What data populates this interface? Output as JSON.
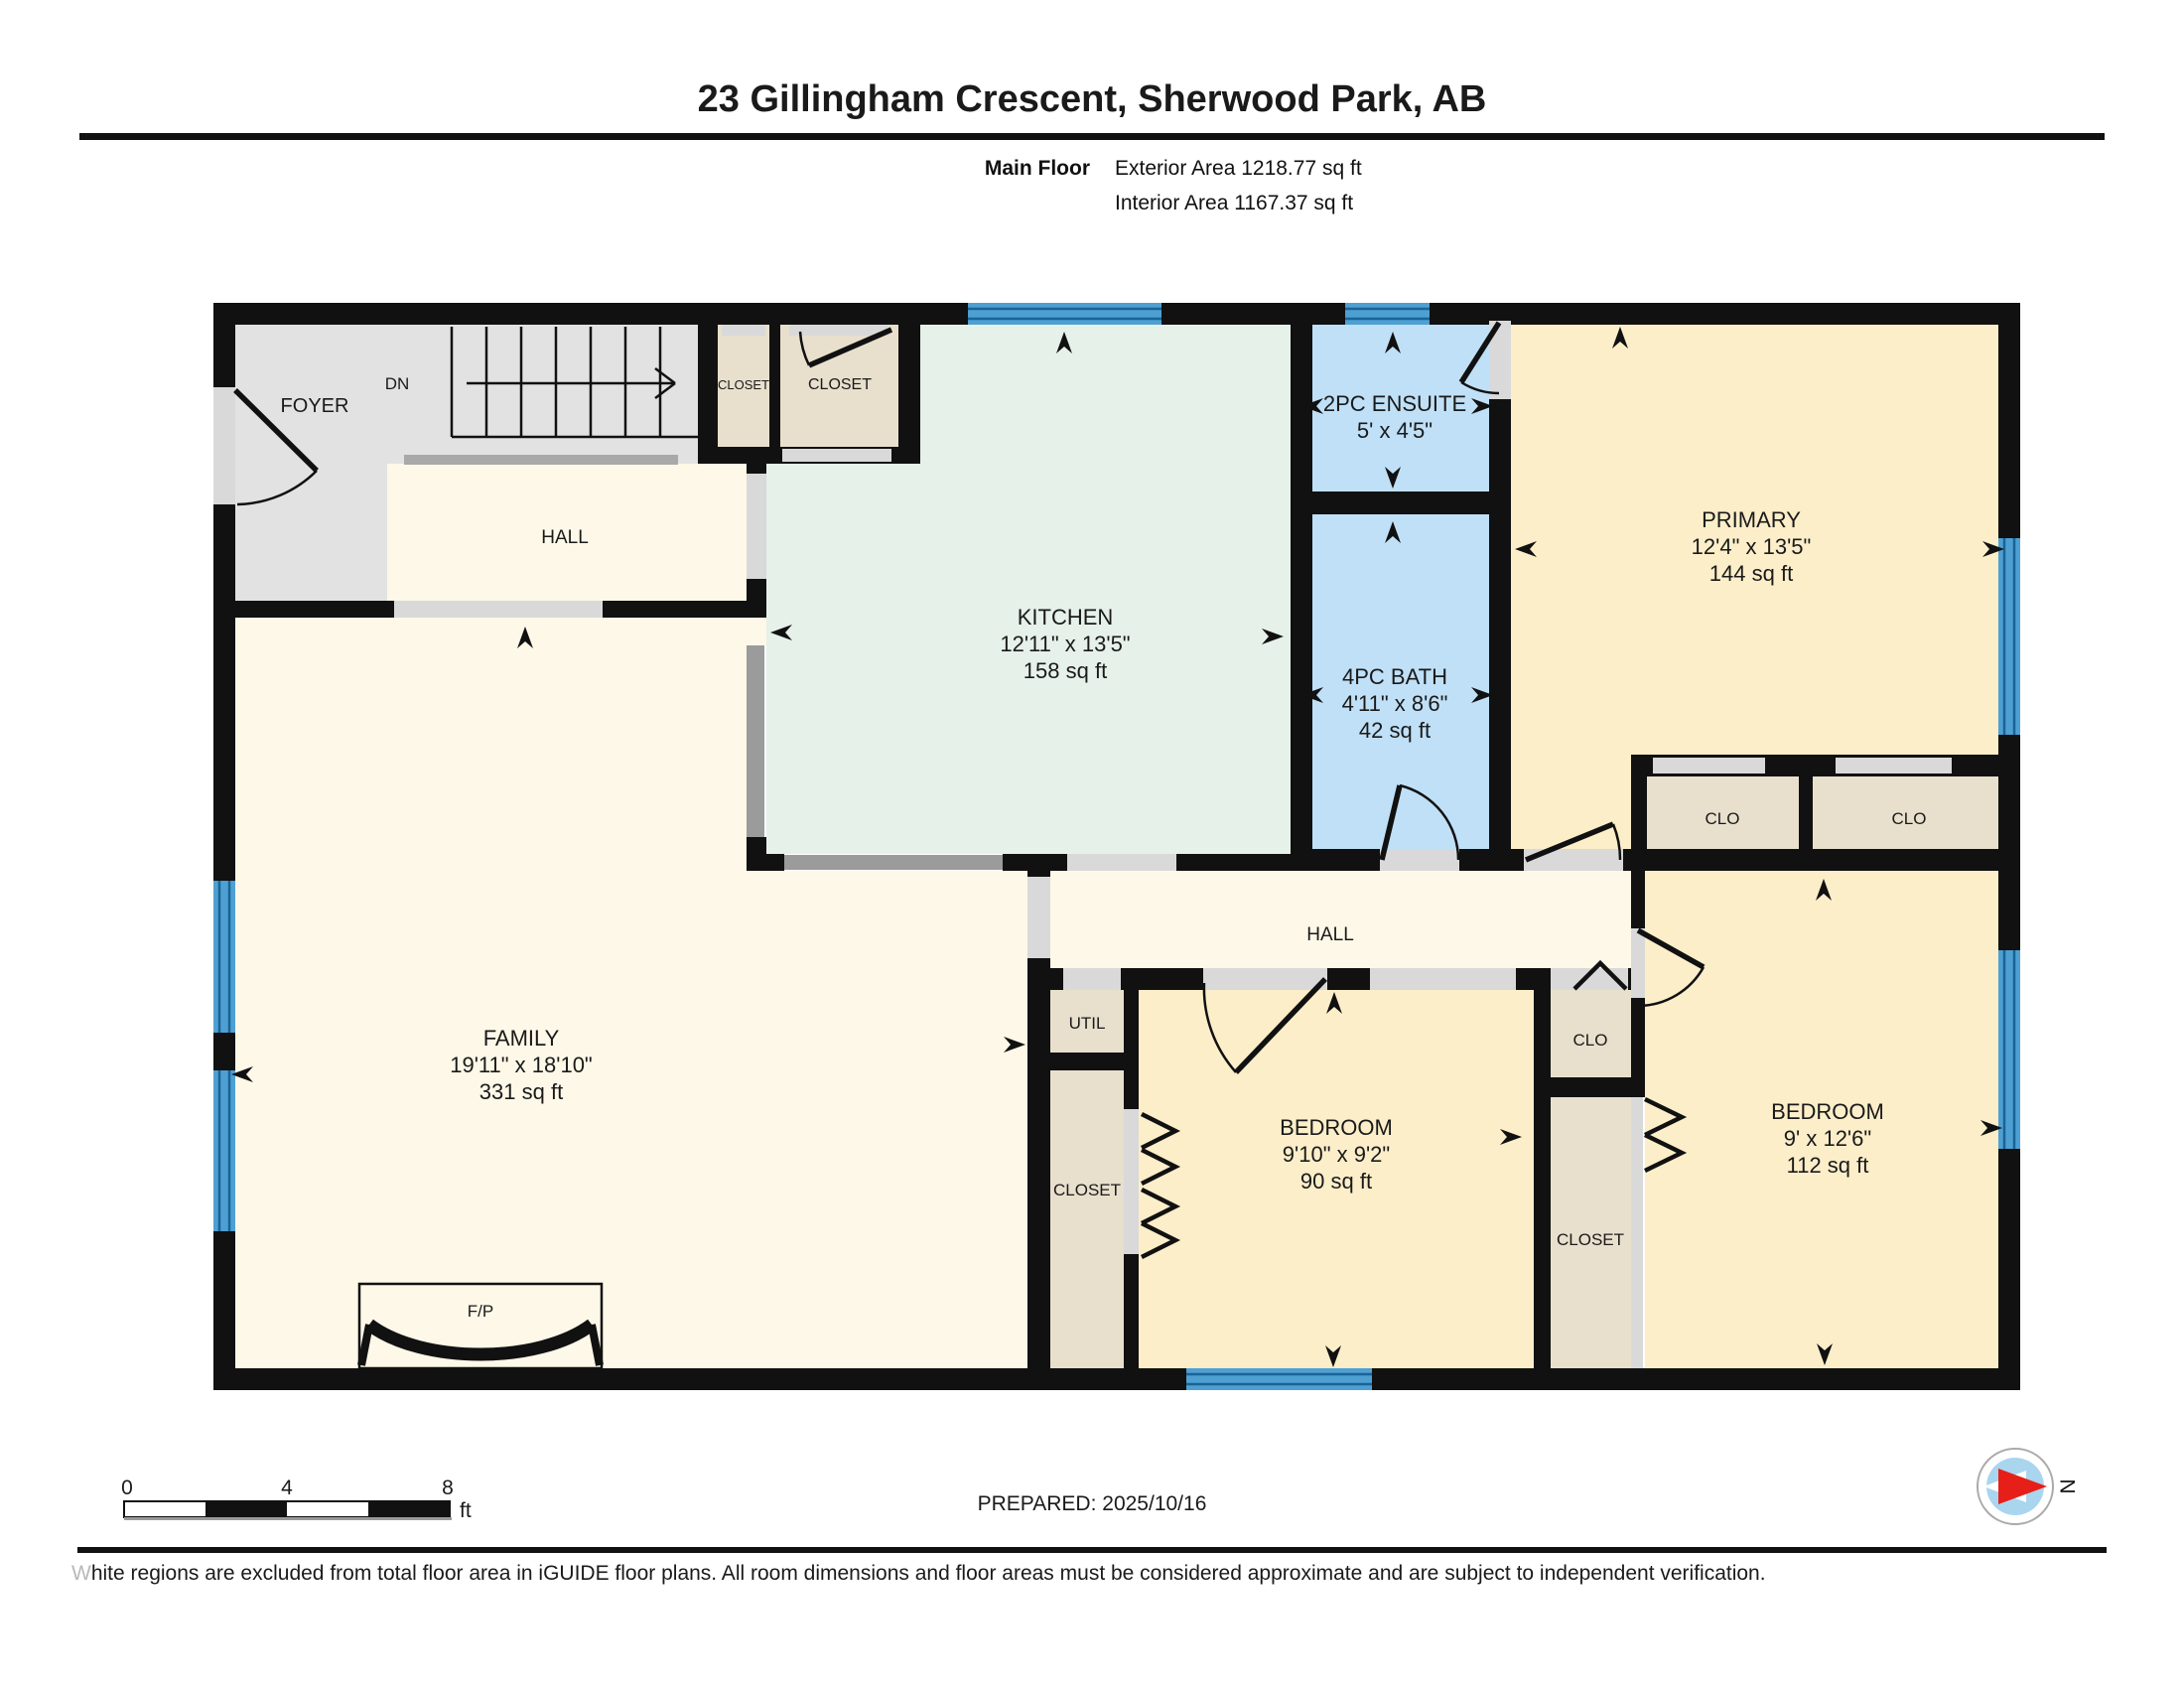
{
  "header": {
    "title": "23 Gillingham Crescent, Sherwood Park, AB",
    "floor_label": "Main Floor",
    "exterior_area": "Exterior Area 1218.77 sq ft",
    "interior_area": "Interior Area 1167.37 sq ft"
  },
  "rooms": {
    "foyer": {
      "name": "FOYER"
    },
    "stairs": {
      "direction": "DN"
    },
    "closet_foyer_small": {
      "name": "CLOSET"
    },
    "closet_foyer": {
      "name": "CLOSET"
    },
    "hall_upper": {
      "name": "HALL"
    },
    "kitchen": {
      "name": "KITCHEN",
      "dims": "12'11\" x 13'5\"",
      "area": "158 sq ft"
    },
    "ensuite": {
      "name": "2PC ENSUITE",
      "dims": "5' x 4'5\""
    },
    "bath": {
      "name": "4PC BATH",
      "dims": "4'11\" x 8'6\"",
      "area": "42 sq ft"
    },
    "primary": {
      "name": "PRIMARY",
      "dims": "12'4\" x 13'5\"",
      "area": "144 sq ft"
    },
    "clo_primary_a": {
      "name": "CLO"
    },
    "clo_primary_b": {
      "name": "CLO"
    },
    "hall_lower": {
      "name": "HALL"
    },
    "family": {
      "name": "FAMILY",
      "dims": "19'11\" x 18'10\"",
      "area": "331 sq ft"
    },
    "fireplace": {
      "name": "F/P"
    },
    "util": {
      "name": "UTIL"
    },
    "closet_bedroom_center": {
      "name": "CLOSET"
    },
    "bedroom_center": {
      "name": "BEDROOM",
      "dims": "9'10\" x 9'2\"",
      "area": "90 sq ft"
    },
    "clo_hall": {
      "name": "CLO"
    },
    "closet_bedroom_right": {
      "name": "CLOSET"
    },
    "bedroom_right": {
      "name": "BEDROOM",
      "dims": "9' x 12'6\"",
      "area": "112 sq ft"
    }
  },
  "scale_bar": {
    "ticks": [
      "0",
      "4",
      "8"
    ],
    "unit": "ft"
  },
  "compass": {
    "label": "N"
  },
  "footer": {
    "prepared": "PREPARED: 2025/10/16",
    "disclaimer_lead": "W",
    "disclaimer_rest": "hite regions are excluded from total floor area in iGUIDE floor plans. All room dimensions and floor areas must be considered approximate and are subject to independent verification."
  },
  "colors": {
    "wall": "#111111",
    "window_blue": "#4ea0d2",
    "bath_blue": "#bfe0f7",
    "kitchen_mint": "#e6f1e9",
    "bedroom_yellow": "#fbeec9",
    "hall_cream": "#fdf8e8",
    "closet_beige": "#e8dfcd",
    "foyer_gray": "#e2e2e2",
    "compass_red": "#e62019",
    "compass_blue": "#a9d5ef"
  }
}
